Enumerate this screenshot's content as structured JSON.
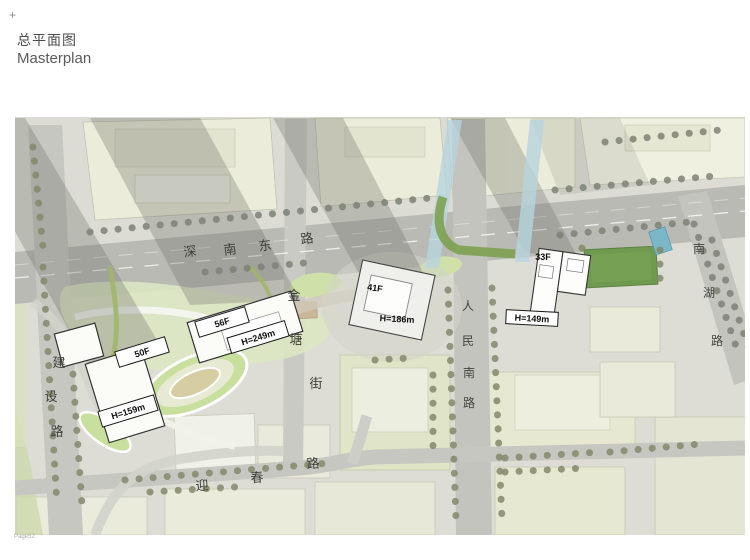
{
  "page": {
    "marker": "+",
    "title_zh": "总平面图",
    "title_en": "Masterplan",
    "page_number": "Page52"
  },
  "plan": {
    "roads": {
      "shennan_east": {
        "name": "深南东路",
        "chars": [
          "深",
          "南",
          "东",
          "路"
        ]
      },
      "jianshe": {
        "name": "建设路",
        "chars": [
          "建",
          "设",
          "路"
        ]
      },
      "jintang": {
        "name": "金塘街",
        "chars": [
          "金",
          "塘",
          "街"
        ]
      },
      "renmin_south": {
        "name": "人民南路",
        "chars": [
          "人",
          "民",
          "南",
          "路"
        ]
      },
      "nanhu": {
        "name": "南湖路",
        "chars": [
          "南",
          "湖",
          "路"
        ]
      },
      "yingchun": {
        "name": "迎春路",
        "chars": [
          "迎",
          "春",
          "路"
        ]
      }
    },
    "buildings": [
      {
        "id": "tower-50f",
        "floors": "50F",
        "height": "H=159m"
      },
      {
        "id": "tower-56f",
        "floors": "56F",
        "height": "H=249m"
      },
      {
        "id": "tower-41f",
        "floors": "41F",
        "height": "H=186m"
      },
      {
        "id": "tower-33f",
        "floors": "33F",
        "height": "H=149m"
      }
    ],
    "colors": {
      "main_road_gray": "#b9bab4",
      "minor_road_gray": "#c6c7c0",
      "context_beige": "#ebecd9",
      "grass_green": "#dce6c2",
      "court_green": "#6f9a4f",
      "water_blue": "#7ab7c9",
      "tree_olive": "#84886b",
      "shadow_gray": "#6b6d66",
      "building_white": "#fbfbf8"
    }
  }
}
